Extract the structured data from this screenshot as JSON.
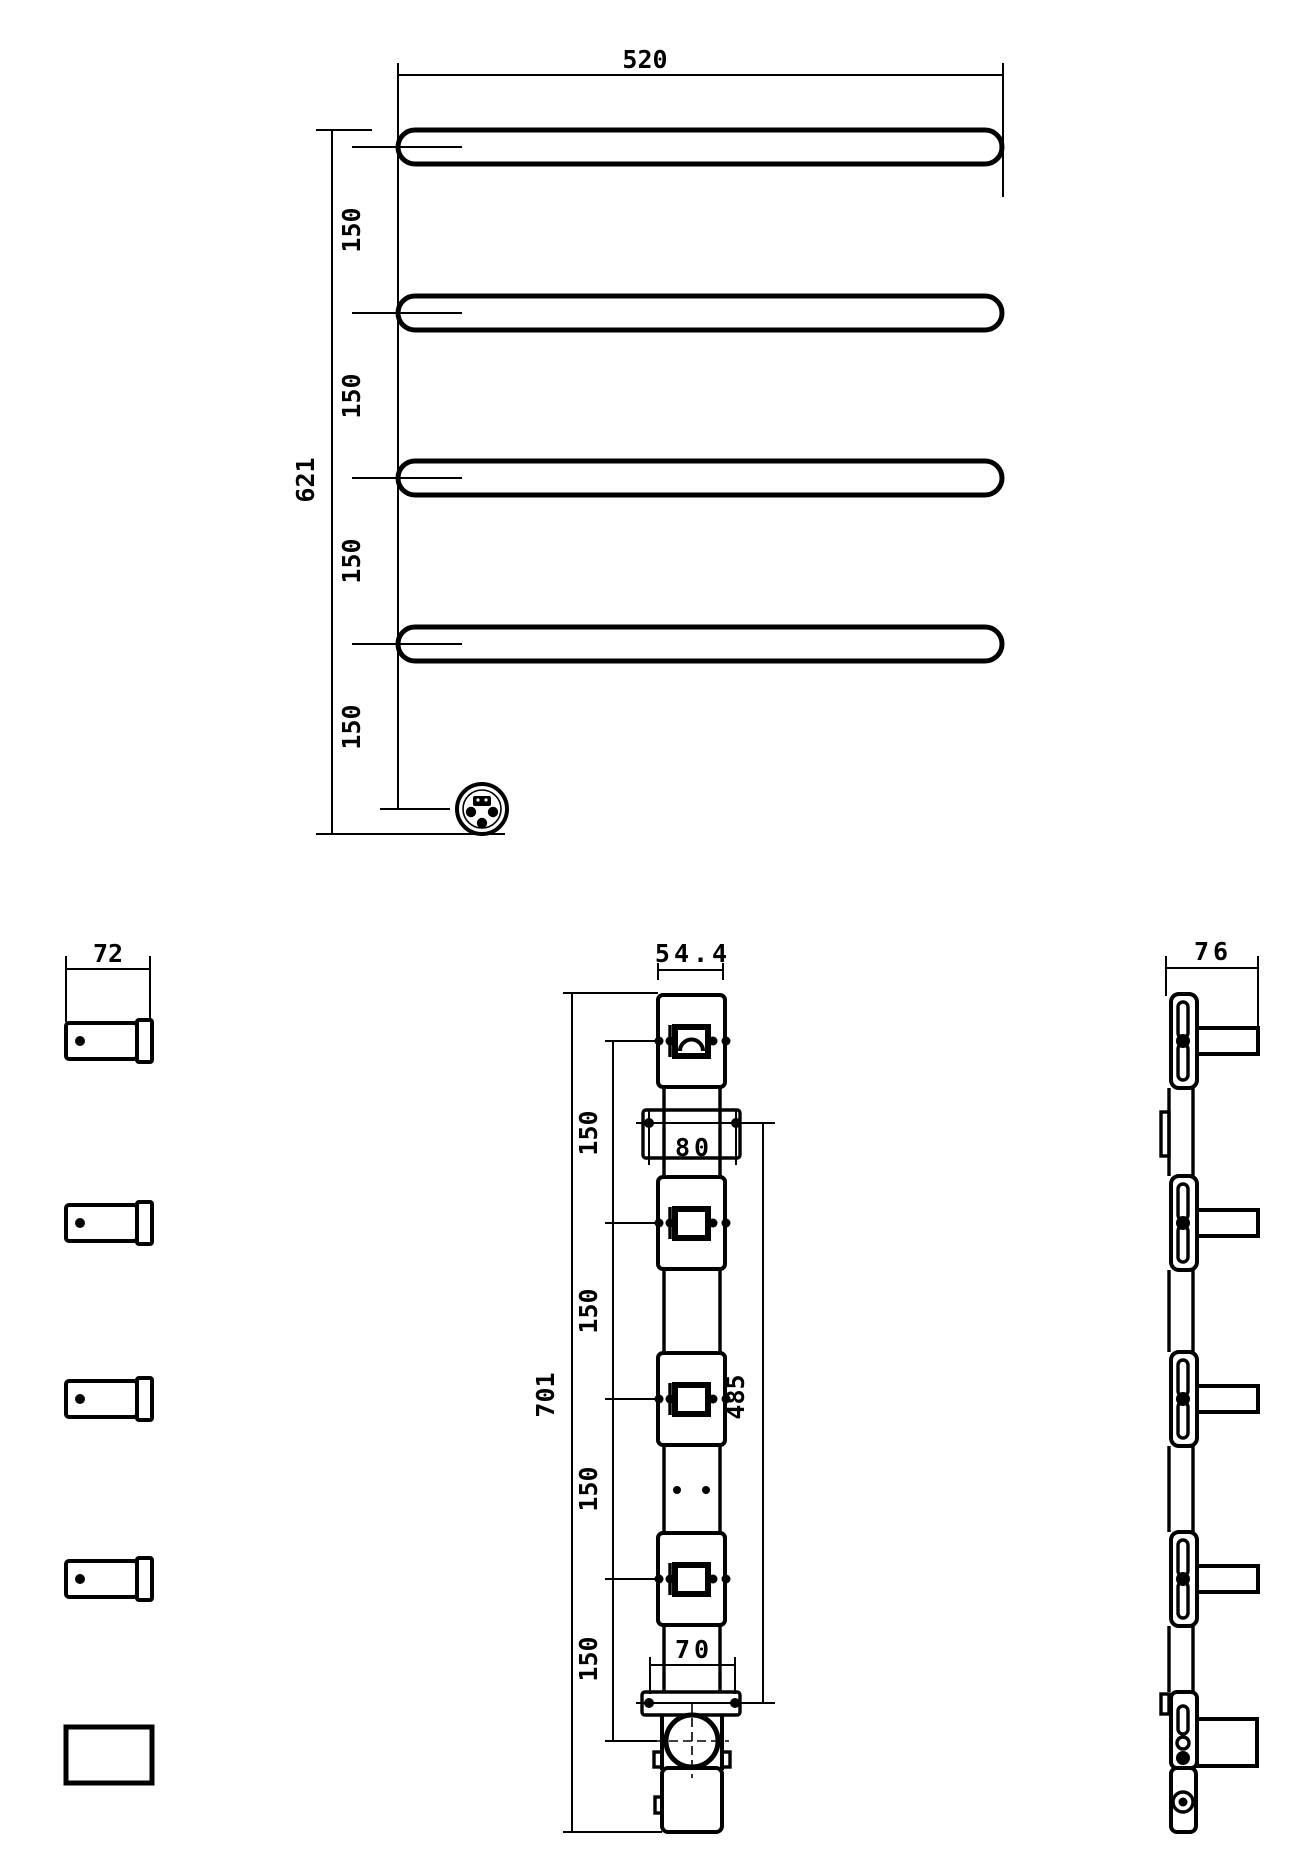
{
  "drawing": {
    "front_view": {
      "width": "520",
      "height": "621",
      "bar_spacing": [
        "150",
        "150",
        "150",
        "150"
      ]
    },
    "bar_end_view": {
      "width": "72"
    },
    "column_front_view": {
      "depth": "54.4",
      "height": "701",
      "bar_spacing": [
        "150",
        "150",
        "150",
        "150"
      ],
      "upper_bracket_hole_spacing": "80",
      "bracket_vertical_spacing": "485",
      "lower_bracket_hole_spacing": "70"
    },
    "column_side_view": {
      "depth": "76"
    },
    "colors": {
      "line": "#000000",
      "background": "#ffffff"
    }
  }
}
